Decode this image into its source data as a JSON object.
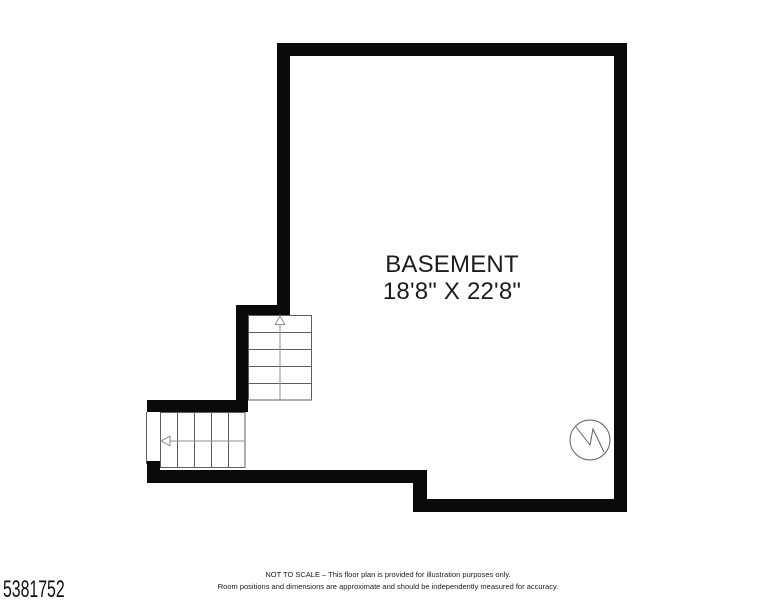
{
  "floorplan": {
    "room_name": "BASEMENT",
    "room_dimensions": "18'8\" X 22'8\"",
    "symbols": {
      "stairs_up_icon": "staircase-with-up-arrow",
      "stairs_lower_icon": "staircase-with-left-arrow",
      "utility_circle_icon": "circle-with-zigzag"
    },
    "colors": {
      "wall": "#0a0a0a",
      "line_dark": "#5f5f5f",
      "line_light": "#8f8f8f",
      "background": "#ffffff",
      "text": "#1c1c1c"
    }
  },
  "footer": {
    "listing_id": "5381752",
    "disclaimer_line1": "NOT TO SCALE – This floor plan is provided for illustration purposes only.",
    "disclaimer_line2": "Room positions and dimensions are approximate and should be independently measured for accuracy."
  }
}
